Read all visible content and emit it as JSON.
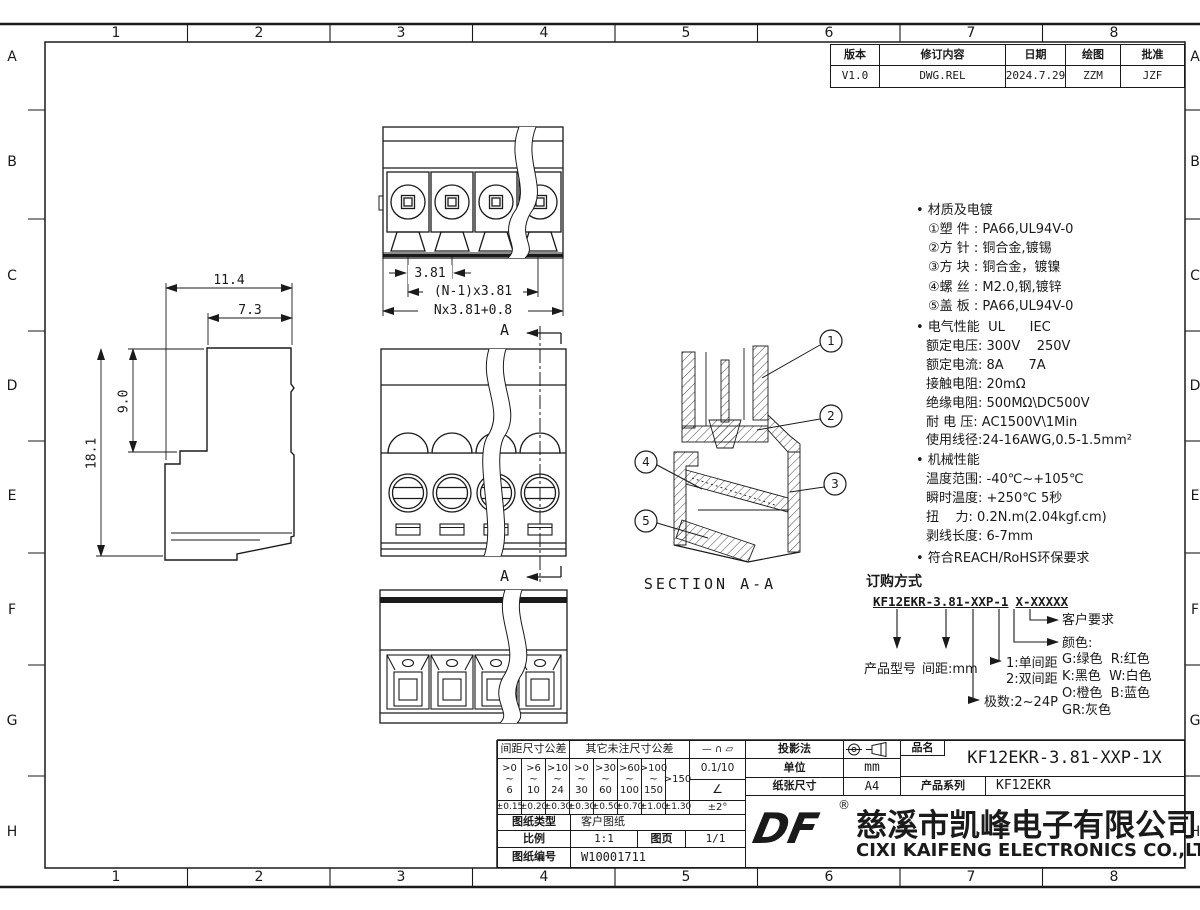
{
  "frame": {
    "columns": [
      "1",
      "2",
      "3",
      "4",
      "5",
      "6",
      "7",
      "8"
    ],
    "rows": [
      "A",
      "B",
      "C",
      "D",
      "E",
      "F",
      "G",
      "H"
    ]
  },
  "revision": {
    "headers": [
      "版本",
      "修订内容",
      "日期",
      "绘图",
      "批准"
    ],
    "row": {
      "version": "V1.0",
      "content": "DWG.REL",
      "date": "2024.7.29",
      "draw": "ZZM",
      "approve": "JZF"
    }
  },
  "notes": {
    "materials_title": "• 材质及电镀",
    "materials": [
      "①塑 件 : PA66,UL94V-0",
      "②方 针 : 铜合金,镀锡",
      "③方 块 : 铜合金，镀镍",
      "④螺 丝 : M2.0,钢,镀锌",
      "⑤盖 板 : PA66,UL94V-0"
    ],
    "electrical_title": "• 电气性能  UL      IEC",
    "electrical": [
      "额定电压: 300V    250V",
      "额定电流: 8A      7A",
      "接触电阻: 20mΩ",
      "绝缘电阻: 500MΩ\\DC500V",
      "耐 电 压: AC1500V\\1Min",
      "使用线径:24-16AWG,0.5-1.5mm²"
    ],
    "mechanical_title": "• 机械性能",
    "mechanical": [
      "温度范围: -40℃~+105℃",
      "瞬时温度: +250℃ 5秒",
      "扭    力: 0.2N.m(2.04kgf.cm)",
      "剥线长度: 6-7mm"
    ],
    "compliance": "• 符合REACH/RoHS环保要求"
  },
  "ordering": {
    "title": "订购方式",
    "code_main": "KF12EKR-3.81-XXP-1",
    "code_suffix": "X-XXXXX",
    "customer": "客户要求",
    "color_title": "颜色:",
    "colors": [
      "G:绿色  R:红色",
      "K:黑色  W:白色",
      "O:橙色  B:蓝色",
      "GR:灰色"
    ],
    "pitch1": "1:单间距",
    "pitch2": "2:双间距",
    "poles": "极数:2~24P",
    "model": "产品型号",
    "pitch": "间距:mm"
  },
  "dims": {
    "d_114": "11.4",
    "d_73": "7.3",
    "d_90": "9.0",
    "d_181": "18.1",
    "t_381": "3.81",
    "t_n1": "(N-1)x3.81",
    "t_n": "Nx3.81+0.8",
    "section": "SECTION A-A",
    "mark": "A",
    "balloons": [
      "1",
      "2",
      "3",
      "4",
      "5"
    ]
  },
  "titleblock": {
    "tol_pitch_header": "间距尺寸公差",
    "tol_other_header": "其它未注尺寸公差",
    "ranges": [
      ">0\n~\n6",
      ">6\n~\n10",
      ">10\n~\n24",
      ">0\n~\n30",
      ">30\n~\n60",
      ">60\n~\n100",
      ">100\n~\n150"
    ],
    "range_last": ">150",
    "tols": [
      "±0.15",
      "±0.20",
      "±0.30",
      "±0.30",
      "±0.50",
      "±0.70",
      "±1.00",
      "±1.30"
    ],
    "angle_tol": "±2°",
    "geo_symbols": "—  ∩  ▱",
    "flatness": "0.1/10",
    "angle_symbol": "∠",
    "projection_label": "投影法",
    "unit_label": "单位",
    "unit_value": "mm",
    "paper_label": "纸张尺寸",
    "paper_value": "A4",
    "name_label": "品名",
    "name_value": "KF12EKR-3.81-XXP-1X",
    "series_label": "产品系列",
    "series_value": "KF12EKR",
    "doctype_label": "图纸类型",
    "doctype_value": "客户图纸",
    "scale_label": "比例",
    "scale_value": "1:1",
    "page_label": "图页",
    "page_value": "1/1",
    "docnum_label": "图纸编号",
    "docnum_value": "W10001711",
    "logo": "DF",
    "reg": "®",
    "company_cn": "慈溪市凯峰电子有限公司",
    "company_en": "CIXI KAIFENG ELECTRONICS CO.,LTD"
  }
}
